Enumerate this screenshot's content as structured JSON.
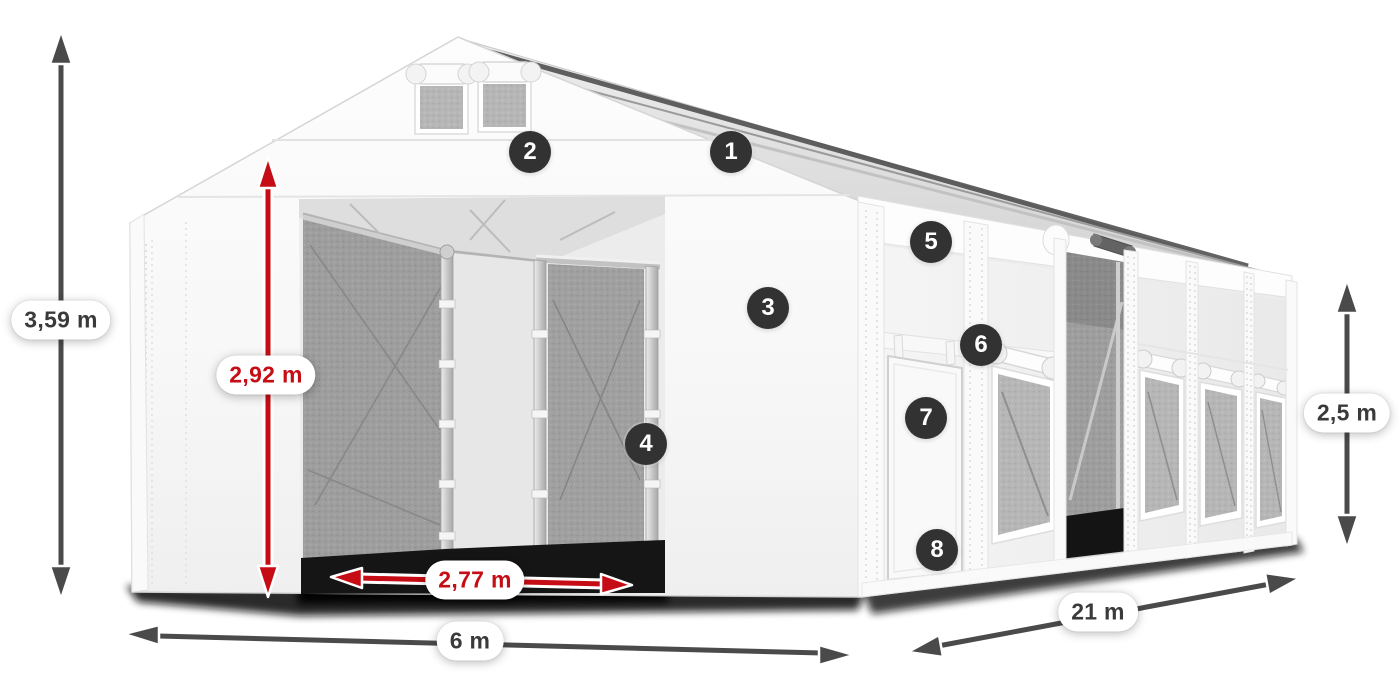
{
  "dimensions": {
    "total_height": "3,59 m",
    "entrance_height": "2,92 m",
    "entrance_width": "2,77 m",
    "front_width": "6 m",
    "side_length": "21 m",
    "side_height": "2,5 m"
  },
  "badges": [
    "1",
    "2",
    "3",
    "4",
    "5",
    "6",
    "7",
    "8"
  ],
  "colors": {
    "accent_red": "#c60d15",
    "arrow_gray": "#4a4a4a",
    "badge_bg": "#323232",
    "badge_text": "#ffffff",
    "background": "#ffffff"
  }
}
